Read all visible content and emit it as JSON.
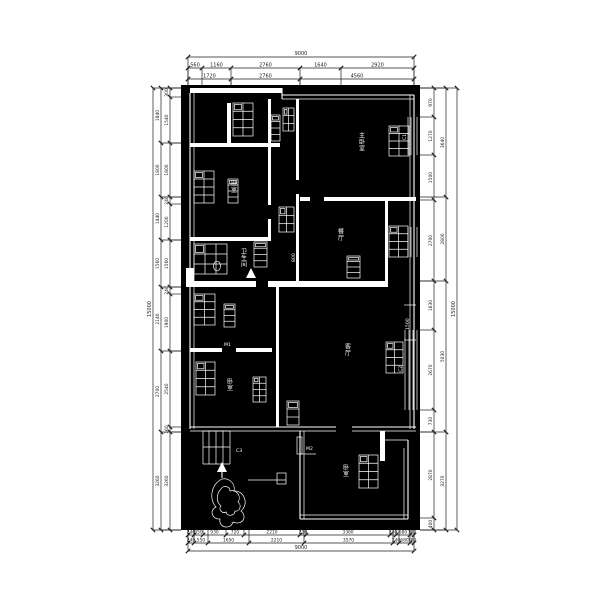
{
  "drawing": {
    "type": "apartment-floor-plan",
    "colors": {
      "paper": "#ffffff",
      "plan_background": "#000000",
      "plan_ink": "#ffffff",
      "dimension_ink": "#1c1c1c"
    },
    "rooms": {
      "master_bedroom": {
        "label": "主卧室"
      },
      "bedroom_2": {
        "label": "卧室"
      },
      "dining": {
        "label": "餐厅"
      },
      "bathroom": {
        "label": "卫生间"
      },
      "living": {
        "label": "客厅"
      },
      "bedroom_3": {
        "label": "卧室"
      },
      "bedroom_4": {
        "label": "卧室"
      }
    },
    "tags": {
      "door_1": "M1",
      "door_2": "M2",
      "window_1": "C1",
      "window_2": "C2",
      "window_3": "C3"
    },
    "inner_dimensions": {
      "window_width": "1500",
      "door_width": "800"
    },
    "dimensions": {
      "top": {
        "overall": "9000",
        "row_1": [
          "560",
          "1160",
          "2760",
          "1640",
          "2920"
        ],
        "row_2": [
          "1720",
          "2760",
          "4560"
        ]
      },
      "bottom": {
        "overall": "9000",
        "row_1": [
          "240",
          "350",
          "930",
          "720",
          "2210",
          "210",
          "3360",
          "240",
          "680",
          "180"
        ],
        "row_2": [
          "240",
          "550",
          "1650",
          "2210",
          "3570",
          "240",
          "680",
          "180"
        ]
      },
      "left": {
        "overall": "15000",
        "inner": [
          "300",
          "1540",
          "1800",
          "240",
          "1200",
          "1560",
          "240",
          "1900",
          "2540",
          "160",
          "3260"
        ],
        "outer": [
          "1840",
          "1800",
          "1440",
          "1560",
          "2140",
          "2700",
          "3260"
        ]
      },
      "right": {
        "overall": "15000",
        "inner": [
          "970",
          "1270",
          "1500",
          "2700",
          "1630",
          "2670",
          "730",
          "2870",
          "400"
        ],
        "outer": [
          "3640",
          "2800",
          "5030",
          "3270"
        ]
      }
    }
  }
}
